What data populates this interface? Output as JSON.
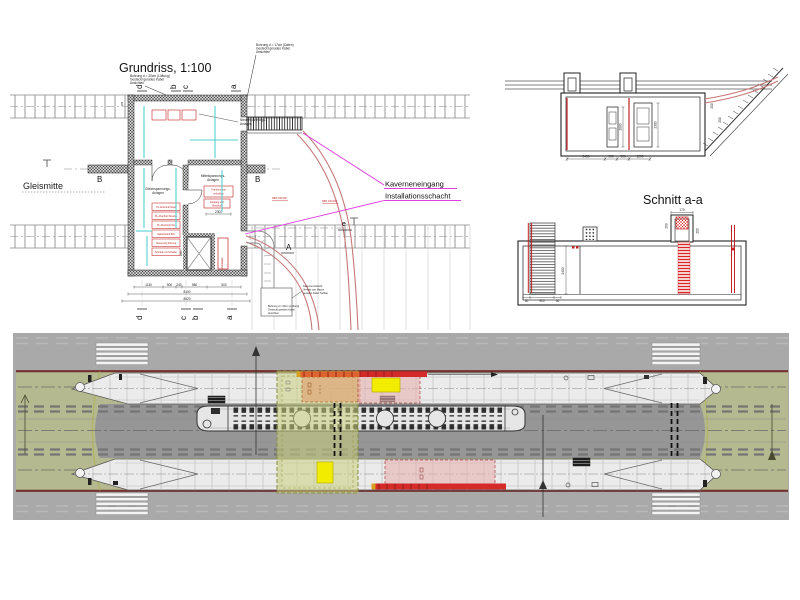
{
  "colors": {
    "paper": "#ffffff",
    "outer_gray": "#a9a9a9",
    "track_gray": "#969696",
    "green_strip": "#b5b98f",
    "platform_white": "#ebebeb",
    "dark_red_edge": "#743030",
    "olive_overlay": "#c9cf7c",
    "orange_overlay": "#dfa878",
    "pink_overlay": "#e8b0b0",
    "yellow_highlight": "#f2ec00",
    "red_bar": "#d42a2a",
    "magenta_leader": "#e23ce2",
    "cable_red": "#c87878",
    "cyan_tray": "#55cfcf",
    "annotation_red": "#c22222"
  },
  "grundriss": {
    "title": "Grundriss, 1:100",
    "gleismitte": "Gleismitte",
    "kaverneneingang": "Kaverneneingang",
    "installationsschacht": "Installationsschacht",
    "rooms": {
      "gleich1": "Gleichspannungs-",
      "gleich2": "Anlagen",
      "mittel1": "Mittelspannungs-",
      "mittel2": "Anlagen",
      "nieder1": "Niederspannungs-",
      "nieder2": "Anlagen"
    },
    "equipment": [
      "PL-Abschnitt West",
      "PL-Abschnitt Strecke",
      "PL-Abschnitt Ost",
      "Stellschrank 5kV",
      "Steuerung Störung",
      "Schrank mit Schalter"
    ],
    "transformator1": "Transformator",
    "transformator2": "einhebbar",
    "erzeuger1": "Eingang und",
    "erzeuger2": "Abschluß",
    "vertbox": "Installation",
    "kbr1": "KBR 100/100",
    "kbr2": "KBR 100/100",
    "markers": {
      "a": "a",
      "b": "b",
      "c": "c",
      "d": "d",
      "e": "e",
      "A": "A",
      "B": "B"
    },
    "notes": {
      "tl1": "Bohrung d = 20cm (Lüftung)",
      "tl2": "Gesteckt gerades Kabel",
      "tl3": "Ansichten",
      "tr1": "Bohrung d = 17cm (Daten)",
      "tr2": "Gesteckt gerades Kabel",
      "tr3": "Ansichten",
      "s1a": "Kavernenschacht",
      "s1b": "Versatz von Masse",
      "s1c": "gerades Kabel Tiefbau",
      "s2a": "Bohrung d = 20cm (Lüftung)",
      "s2b": "Gesteckt gerades Kabel",
      "s2c": "Ansichten"
    },
    "dims": {
      "row1": [
        "1130",
        "500",
        "240",
        "980",
        "500"
      ],
      "total1": "8100",
      "total2": "8520",
      "left": "235",
      "room": "2300",
      "shaft": "1600"
    }
  },
  "querschnitt": {
    "bottom": [
      "2450",
      "900",
      "900",
      "1200"
    ],
    "heights": [
      "2000",
      "2300"
    ],
    "slope": [
      "200",
      "200"
    ]
  },
  "schnitt": {
    "title": "Schnitt a-a",
    "top": "170",
    "left": "200",
    "right": "200",
    "height": "2400",
    "b1": "50",
    "b2": "900",
    "b3": "50"
  }
}
